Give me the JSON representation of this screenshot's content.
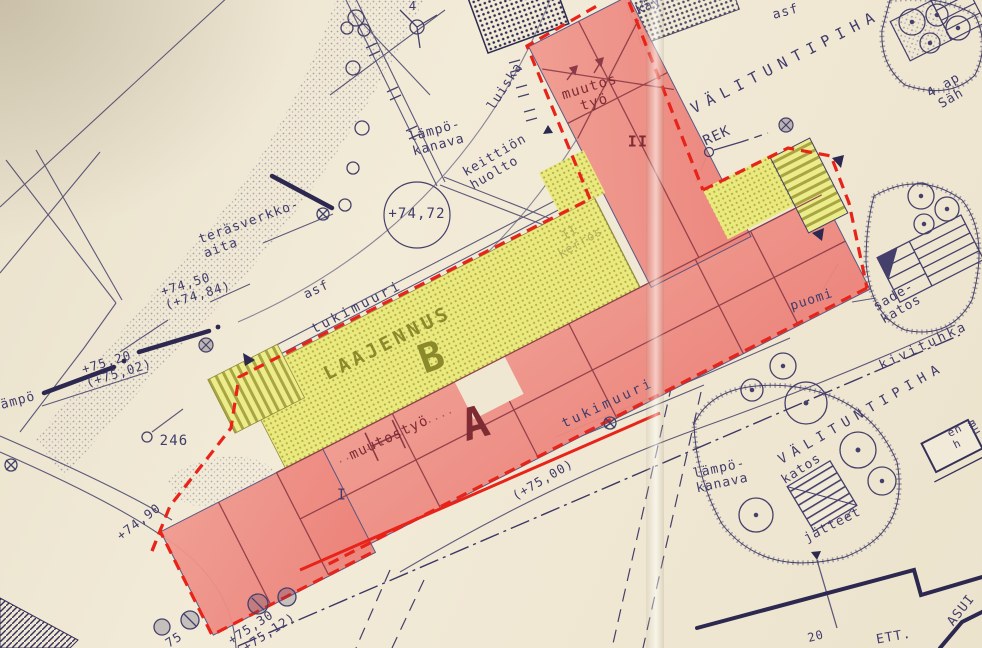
{
  "document": {
    "type": "site-plan",
    "language": "fi"
  },
  "colors": {
    "paper": "#efe7d2",
    "ink": "#45406b",
    "building_a_fill": "#ef8d84",
    "building_b_fill": "#e9e97e",
    "boundary_red": "#e8231a",
    "annotation_maroon": "#7e2b34",
    "annotation_olive": "#8a8a2c"
  },
  "labels": {
    "corner_4": "4",
    "asf_top": "asf",
    "valituntipiha_top": "VÄLITUNTIPIHA",
    "kay": "käy",
    "parking": "4 ap\nSäh",
    "rek": "REK",
    "muutostyo_wing": "muutos\ntyö",
    "floor_ii": "II",
    "luiska": "luiska",
    "lampokanava_top": "lämpö-\nkanava",
    "keittion_huolto": "keittiön\nhuolto",
    "terasverkkoaita": "teräsverkko-\naita",
    "elev_7472": "+74,72",
    "elev_7450": "+74,50\n(+74,84)",
    "asf_left": "asf",
    "tukimuuri_upper": "tukimuuri",
    "laajennus": "LAAJENNUS",
    "building_b": "B",
    "floor_note": "II-\nkerros",
    "elev_7520": "+75,20\n(+75,02)",
    "lampo_left": "lämpö",
    "tree_246": "246",
    "building_a": "A",
    "muutostyo_a": "muutostyö",
    "floor_i": "I",
    "tukimuuri_lower": "tukimuuri",
    "elev_7500": "(+75,00)",
    "puomi": "puomi",
    "sadekatos": "sade-\nkatos",
    "kivituhka": "kivituhka",
    "valituntipiha_bottom": "VÄLITUNTIPIHA",
    "lampokanava_bottom": "lämpö-\nkanava",
    "katos": "katos",
    "jatteet": "jätteet",
    "en_h": "en\nh",
    "elev_7490": "+74,90",
    "elev_7530": "+75,30\n(+75,12)",
    "elev_75_partial": "75",
    "asui": "ASUI",
    "ett": "ETT.",
    "num_20": "20",
    "mu_edge": "mu"
  }
}
